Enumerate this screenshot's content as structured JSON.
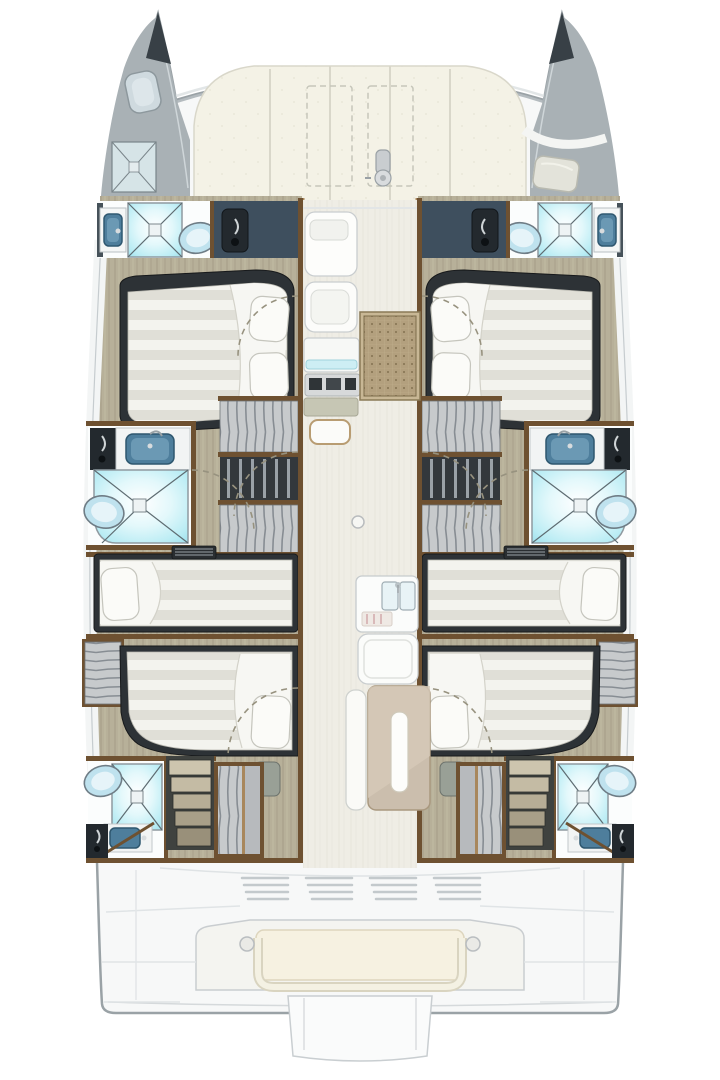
{
  "title": "Catamaran yacht accommodation deck plan (top view, bow up)",
  "image_type": "boat-floor-plan",
  "orientation": {
    "bow": "top",
    "stern": "bottom"
  },
  "counts": {
    "hulls": 2,
    "guest_cabins": 6,
    "heads": 6,
    "forepeak_crew_areas": 2
  },
  "palette": {
    "page_bg": "#ffffff",
    "hull_fill": "#f7f8f8",
    "hull_stroke": "#9aa2a6",
    "deck_line": "#dfe3e5",
    "bow_tip": "#384046",
    "forepeak_gray": "#a9b1b5",
    "sunpad_cream": "#f4f2e6",
    "sunpad_line": "#d9d7ca",
    "teak_floor": "#b7b099",
    "corridor_floor": "#efede5",
    "wood_trim": "#6e5131",
    "wood_light": "#a8875c",
    "bulkhead_navy": "#3e4f5e",
    "door_dark": "#23292e",
    "furniture_dark": "#2d3236",
    "shower_cyan": "#93dcea",
    "fixture_white": "#fbfdfd",
    "sink_basin_blue": "#4e7e9c",
    "toilet_blue": "#bfe2ee",
    "duvet_light": "#f3f3ee",
    "duvet_shade": "#e0dfd7",
    "locker_gray": "#c7cacc",
    "mat_rattan": "#b3a07e",
    "table_tan": "#cbbead",
    "cushion_cream": "#f6f1e1",
    "stairs_wood": "#cdc5ae"
  },
  "foredeck": {
    "sunpad_panels": 5,
    "dashed_deck_hatches": 2,
    "windlass": true,
    "port_forepeak_fixtures": [
      "toilet",
      "shower-pan"
    ],
    "starboard_forepeak_fixtures": [
      "berth-cushion",
      "deck-camber-line"
    ]
  },
  "port_hull": {
    "rooms": [
      {
        "name": "forward-head",
        "fixtures": [
          "wall-sink",
          "shower",
          "toilet",
          "navy-wardrobe-with-door"
        ]
      },
      {
        "name": "forward-cabin",
        "fixtures": [
          "island-double-bed",
          "two-pillows",
          "locker-column"
        ]
      },
      {
        "name": "locker-column",
        "fixtures": [
          "hanging-locker",
          "open-shelves",
          "hanging-locker"
        ]
      },
      {
        "name": "mid-head",
        "fixtures": [
          "navy-wardrobe",
          "sink",
          "corner-shower",
          "toilet",
          "door-swing-arcs"
        ]
      },
      {
        "name": "mid-forward-cabin",
        "fixtures": [
          "athwartships-double-bed",
          "pillow-outboard",
          "louver-vent"
        ]
      },
      {
        "name": "mid-aft-cabin",
        "fixtures": [
          "athwartships-double-bed",
          "pillow-inboard",
          "hanging-wardrobe",
          "deck-hatch"
        ]
      },
      {
        "name": "aft-head",
        "fixtures": [
          "toilet",
          "shower",
          "sink",
          "navy-wardrobe"
        ]
      },
      {
        "name": "aft-companionway",
        "fixtures": [
          "five-step-stairs",
          "hanging-locker"
        ]
      }
    ]
  },
  "starboard_hull": {
    "mirror_of": "port_hull"
  },
  "main_deck": {
    "saloon": [
      "forward-cabinet",
      "settee",
      "nav-desk-with-cyan-edge",
      "instrument-panel-screens",
      "side-desk",
      "stool",
      "rattan-floor-mat"
    ],
    "galley": [
      "double-sink",
      "faucet",
      "worktop-strip",
      "bench-seat"
    ],
    "dinette": [
      "side-bench",
      "rectangular-table",
      "white-table-insert"
    ],
    "floor_hatch_circle": 1
  },
  "cockpit": {
    "louver_vent_groups": 4,
    "bench": {
      "cream_cushion": true,
      "grab_rail": true,
      "grommets": 2
    },
    "transom_center_platform": true
  }
}
